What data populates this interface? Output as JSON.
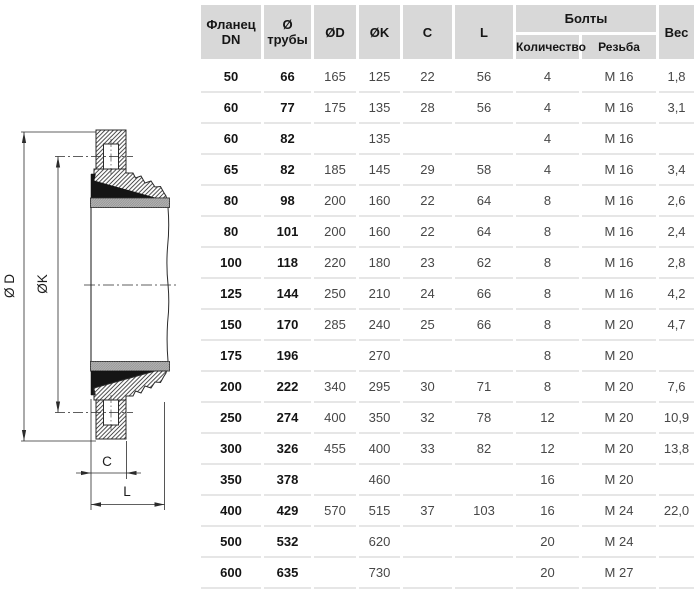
{
  "colors": {
    "header_bg": "#d8d8d8",
    "row_divider": "#e6e6e6",
    "line": "#2b2b2b",
    "gasket_gray": "#b4b4b4",
    "seal_black": "#151515"
  },
  "drawing": {
    "dim_outer": "Ø D",
    "dim_bolt_circle": "ØK",
    "dim_c": "C",
    "dim_l": "L"
  },
  "table": {
    "header": {
      "flange_line1": "Фланец",
      "flange_line2": "DN",
      "pipe_line1": "Ø",
      "pipe_line2": "трубы",
      "d": "ØD",
      "k": "ØK",
      "c": "C",
      "l": "L",
      "bolts": "Болты",
      "bolts_qty": "Количество",
      "bolts_thread": "Резьба",
      "weight": "Вес"
    },
    "rows": [
      [
        "50",
        "66",
        "165",
        "125",
        "22",
        "56",
        "4",
        "M 16",
        "1,8"
      ],
      [
        "60",
        "77",
        "175",
        "135",
        "28",
        "56",
        "4",
        "M 16",
        "3,1"
      ],
      [
        "60",
        "82",
        "",
        "135",
        "",
        "",
        "4",
        "M 16",
        ""
      ],
      [
        "65",
        "82",
        "185",
        "145",
        "29",
        "58",
        "4",
        "M 16",
        "3,4"
      ],
      [
        "80",
        "98",
        "200",
        "160",
        "22",
        "64",
        "8",
        "M 16",
        "2,6"
      ],
      [
        "80",
        "101",
        "200",
        "160",
        "22",
        "64",
        "8",
        "M 16",
        "2,4"
      ],
      [
        "100",
        "118",
        "220",
        "180",
        "23",
        "62",
        "8",
        "M 16",
        "2,8"
      ],
      [
        "125",
        "144",
        "250",
        "210",
        "24",
        "66",
        "8",
        "M 16",
        "4,2"
      ],
      [
        "150",
        "170",
        "285",
        "240",
        "25",
        "66",
        "8",
        "M 20",
        "4,7"
      ],
      [
        "175",
        "196",
        "",
        "270",
        "",
        "",
        "8",
        "M 20",
        ""
      ],
      [
        "200",
        "222",
        "340",
        "295",
        "30",
        "71",
        "8",
        "M 20",
        "7,6"
      ],
      [
        "250",
        "274",
        "400",
        "350",
        "32",
        "78",
        "12",
        "M 20",
        "10,9"
      ],
      [
        "300",
        "326",
        "455",
        "400",
        "33",
        "82",
        "12",
        "M 20",
        "13,8"
      ],
      [
        "350",
        "378",
        "",
        "460",
        "",
        "",
        "16",
        "M 20",
        ""
      ],
      [
        "400",
        "429",
        "570",
        "515",
        "37",
        "103",
        "16",
        "M 24",
        "22,0"
      ],
      [
        "500",
        "532",
        "",
        "620",
        "",
        "",
        "20",
        "M 24",
        ""
      ],
      [
        "600",
        "635",
        "",
        "730",
        "",
        "",
        "20",
        "M 27",
        ""
      ]
    ]
  }
}
